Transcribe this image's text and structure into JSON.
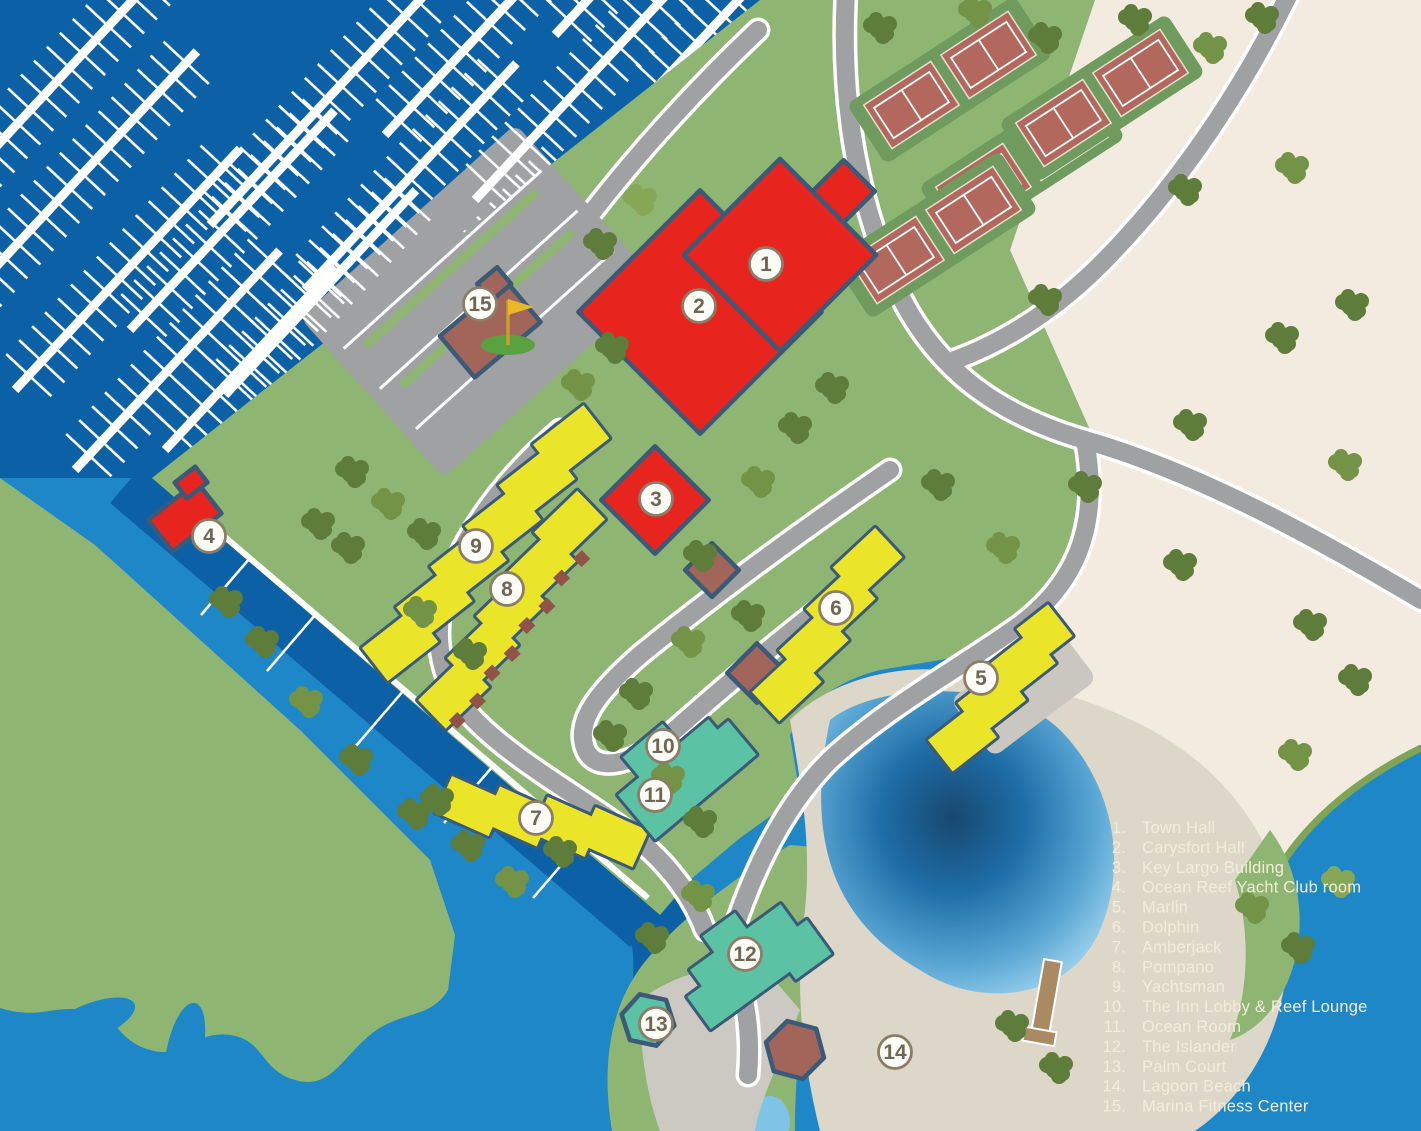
{
  "legend": {
    "items": [
      {
        "num": "1.",
        "label": "Town Hall"
      },
      {
        "num": "2.",
        "label": "Carysfort Hall"
      },
      {
        "num": "3.",
        "label": "Key Largo Building"
      },
      {
        "num": "4.",
        "label": "Ocean Reef Yacht Club room"
      },
      {
        "num": "5.",
        "label": "Marlin"
      },
      {
        "num": "6.",
        "label": "Dolphin"
      },
      {
        "num": "7.",
        "label": "Amberjack"
      },
      {
        "num": "8.",
        "label": "Pompano"
      },
      {
        "num": "9.",
        "label": "Yachtsman"
      },
      {
        "num": "10.",
        "label": "The Inn Lobby & Reef Lounge"
      },
      {
        "num": "11.",
        "label": "Ocean Room"
      },
      {
        "num": "12.",
        "label": "The Islander"
      },
      {
        "num": "13.",
        "label": "Palm Court"
      },
      {
        "num": "14.",
        "label": "Lagoon Beach"
      },
      {
        "num": "15.",
        "label": "Marina Fitness Center"
      }
    ]
  },
  "markers": [
    {
      "num": "1",
      "x": 766,
      "y": 264
    },
    {
      "num": "2",
      "x": 699,
      "y": 306
    },
    {
      "num": "3",
      "x": 656,
      "y": 499
    },
    {
      "num": "4",
      "x": 209,
      "y": 536
    },
    {
      "num": "5",
      "x": 981,
      "y": 678
    },
    {
      "num": "6",
      "x": 836,
      "y": 608
    },
    {
      "num": "7",
      "x": 536,
      "y": 818
    },
    {
      "num": "8",
      "x": 507,
      "y": 589
    },
    {
      "num": "9",
      "x": 476,
      "y": 546
    },
    {
      "num": "10",
      "x": 663,
      "y": 746
    },
    {
      "num": "11",
      "x": 655,
      "y": 795
    },
    {
      "num": "12",
      "x": 745,
      "y": 954
    },
    {
      "num": "13",
      "x": 656,
      "y": 1024
    },
    {
      "num": "14",
      "x": 895,
      "y": 1052
    },
    {
      "num": "15",
      "x": 480,
      "y": 304
    }
  ],
  "palette": {
    "water_light": "#1e87c8",
    "water_dark": "#0c61a6",
    "land_green": "#8fb573",
    "tennis_pad_green": "#6f9c5e",
    "golf_beige": "#f3ebdf",
    "road_gray": "#9fa1a3",
    "sand": "#dcd7c9",
    "building_red": "#e8241f",
    "building_yellow": "#ebe52a",
    "building_teal": "#5cc2a4",
    "building_brown": "#a2655a",
    "building_outline": "#3a5a78",
    "tennis_court": "#b2685c",
    "tree_green": "#5e7c3a",
    "dock_white": "#ffffff",
    "legend_text": "#f2edda",
    "marker_border": "#8c7d68",
    "marker_number": "#6f6656"
  }
}
